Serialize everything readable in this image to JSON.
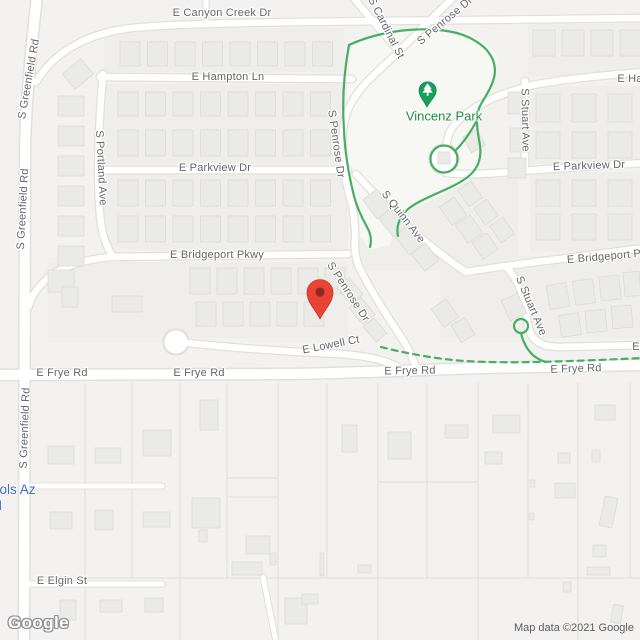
{
  "map": {
    "watermark": "Google",
    "attribution": "Map data ©2021 Google"
  },
  "park": {
    "name": "Vincenz Park",
    "label_x": 444,
    "label_y": 116,
    "pin_x": 427,
    "pin_y": 107
  },
  "school_label": {
    "line1": "ools Az",
    "line2": "ol",
    "x": -8,
    "y1": 482,
    "y2": 499
  },
  "marker": {
    "x": 320,
    "y": 319,
    "color": "#EA4335"
  },
  "colors": {
    "background": "#f3f2f0",
    "road_fill": "#ffffff",
    "road_casing": "#e1e0db",
    "street_label": "#63666b",
    "park_green": "#1e8e3e",
    "path_green": "#47ae63",
    "school_blue": "#3f6ac4",
    "marker_red": "#EA4335",
    "house": "#eaeae7"
  },
  "street_labels": [
    {
      "t": "E Canyon Creek Dr",
      "x": 222,
      "y": 13,
      "r": 0
    },
    {
      "t": "S Greenfield Rd",
      "x": 29,
      "y": 79,
      "r": -80
    },
    {
      "t": "S Greenfield Rd",
      "x": 23,
      "y": 209,
      "r": -87
    },
    {
      "t": "S Greenfield Rd",
      "x": 25,
      "y": 428,
      "r": -88
    },
    {
      "t": "E Hampton Ln",
      "x": 228,
      "y": 77,
      "r": 0
    },
    {
      "t": "E Ha",
      "x": 630,
      "y": 79,
      "r": 0
    },
    {
      "t": "S Portland Ave",
      "x": 101,
      "y": 168,
      "r": 87
    },
    {
      "t": "E Parkview Dr",
      "x": 215,
      "y": 168,
      "r": 0
    },
    {
      "t": "E Parkview Dr",
      "x": 589,
      "y": 166,
      "r": -2
    },
    {
      "t": "E Bridgeport Pkwy",
      "x": 217,
      "y": 255,
      "r": 0
    },
    {
      "t": "E Bridgeport P",
      "x": 604,
      "y": 257,
      "r": -5
    },
    {
      "t": "S Cardinal St",
      "x": 386,
      "y": 28,
      "r": 63
    },
    {
      "t": "S Penrose Dr",
      "x": 445,
      "y": 21,
      "r": -40
    },
    {
      "t": "S Penrose Dr",
      "x": 336,
      "y": 144,
      "r": 82
    },
    {
      "t": "S Penrose Dr",
      "x": 348,
      "y": 292,
      "r": 57
    },
    {
      "t": "S Quinn Ave",
      "x": 403,
      "y": 217,
      "r": 52
    },
    {
      "t": "S Stuart Ave",
      "x": 525,
      "y": 120,
      "r": 89
    },
    {
      "t": "S Stuart Ave",
      "x": 531,
      "y": 306,
      "r": 67
    },
    {
      "t": "E Lowell Ct",
      "x": 331,
      "y": 345,
      "r": -11
    },
    {
      "t": "E Frye Rd",
      "x": 62,
      "y": 373,
      "r": 0
    },
    {
      "t": "E Frye Rd",
      "x": 199,
      "y": 373,
      "r": 0
    },
    {
      "t": "E Frye Rd",
      "x": 410,
      "y": 371,
      "r": -1
    },
    {
      "t": "E Frye Rd",
      "x": 576,
      "y": 369,
      "r": -2
    },
    {
      "t": "E",
      "x": 636,
      "y": 347,
      "r": 0
    },
    {
      "t": "E Elgin St",
      "x": 62,
      "y": 581,
      "r": 0
    }
  ]
}
